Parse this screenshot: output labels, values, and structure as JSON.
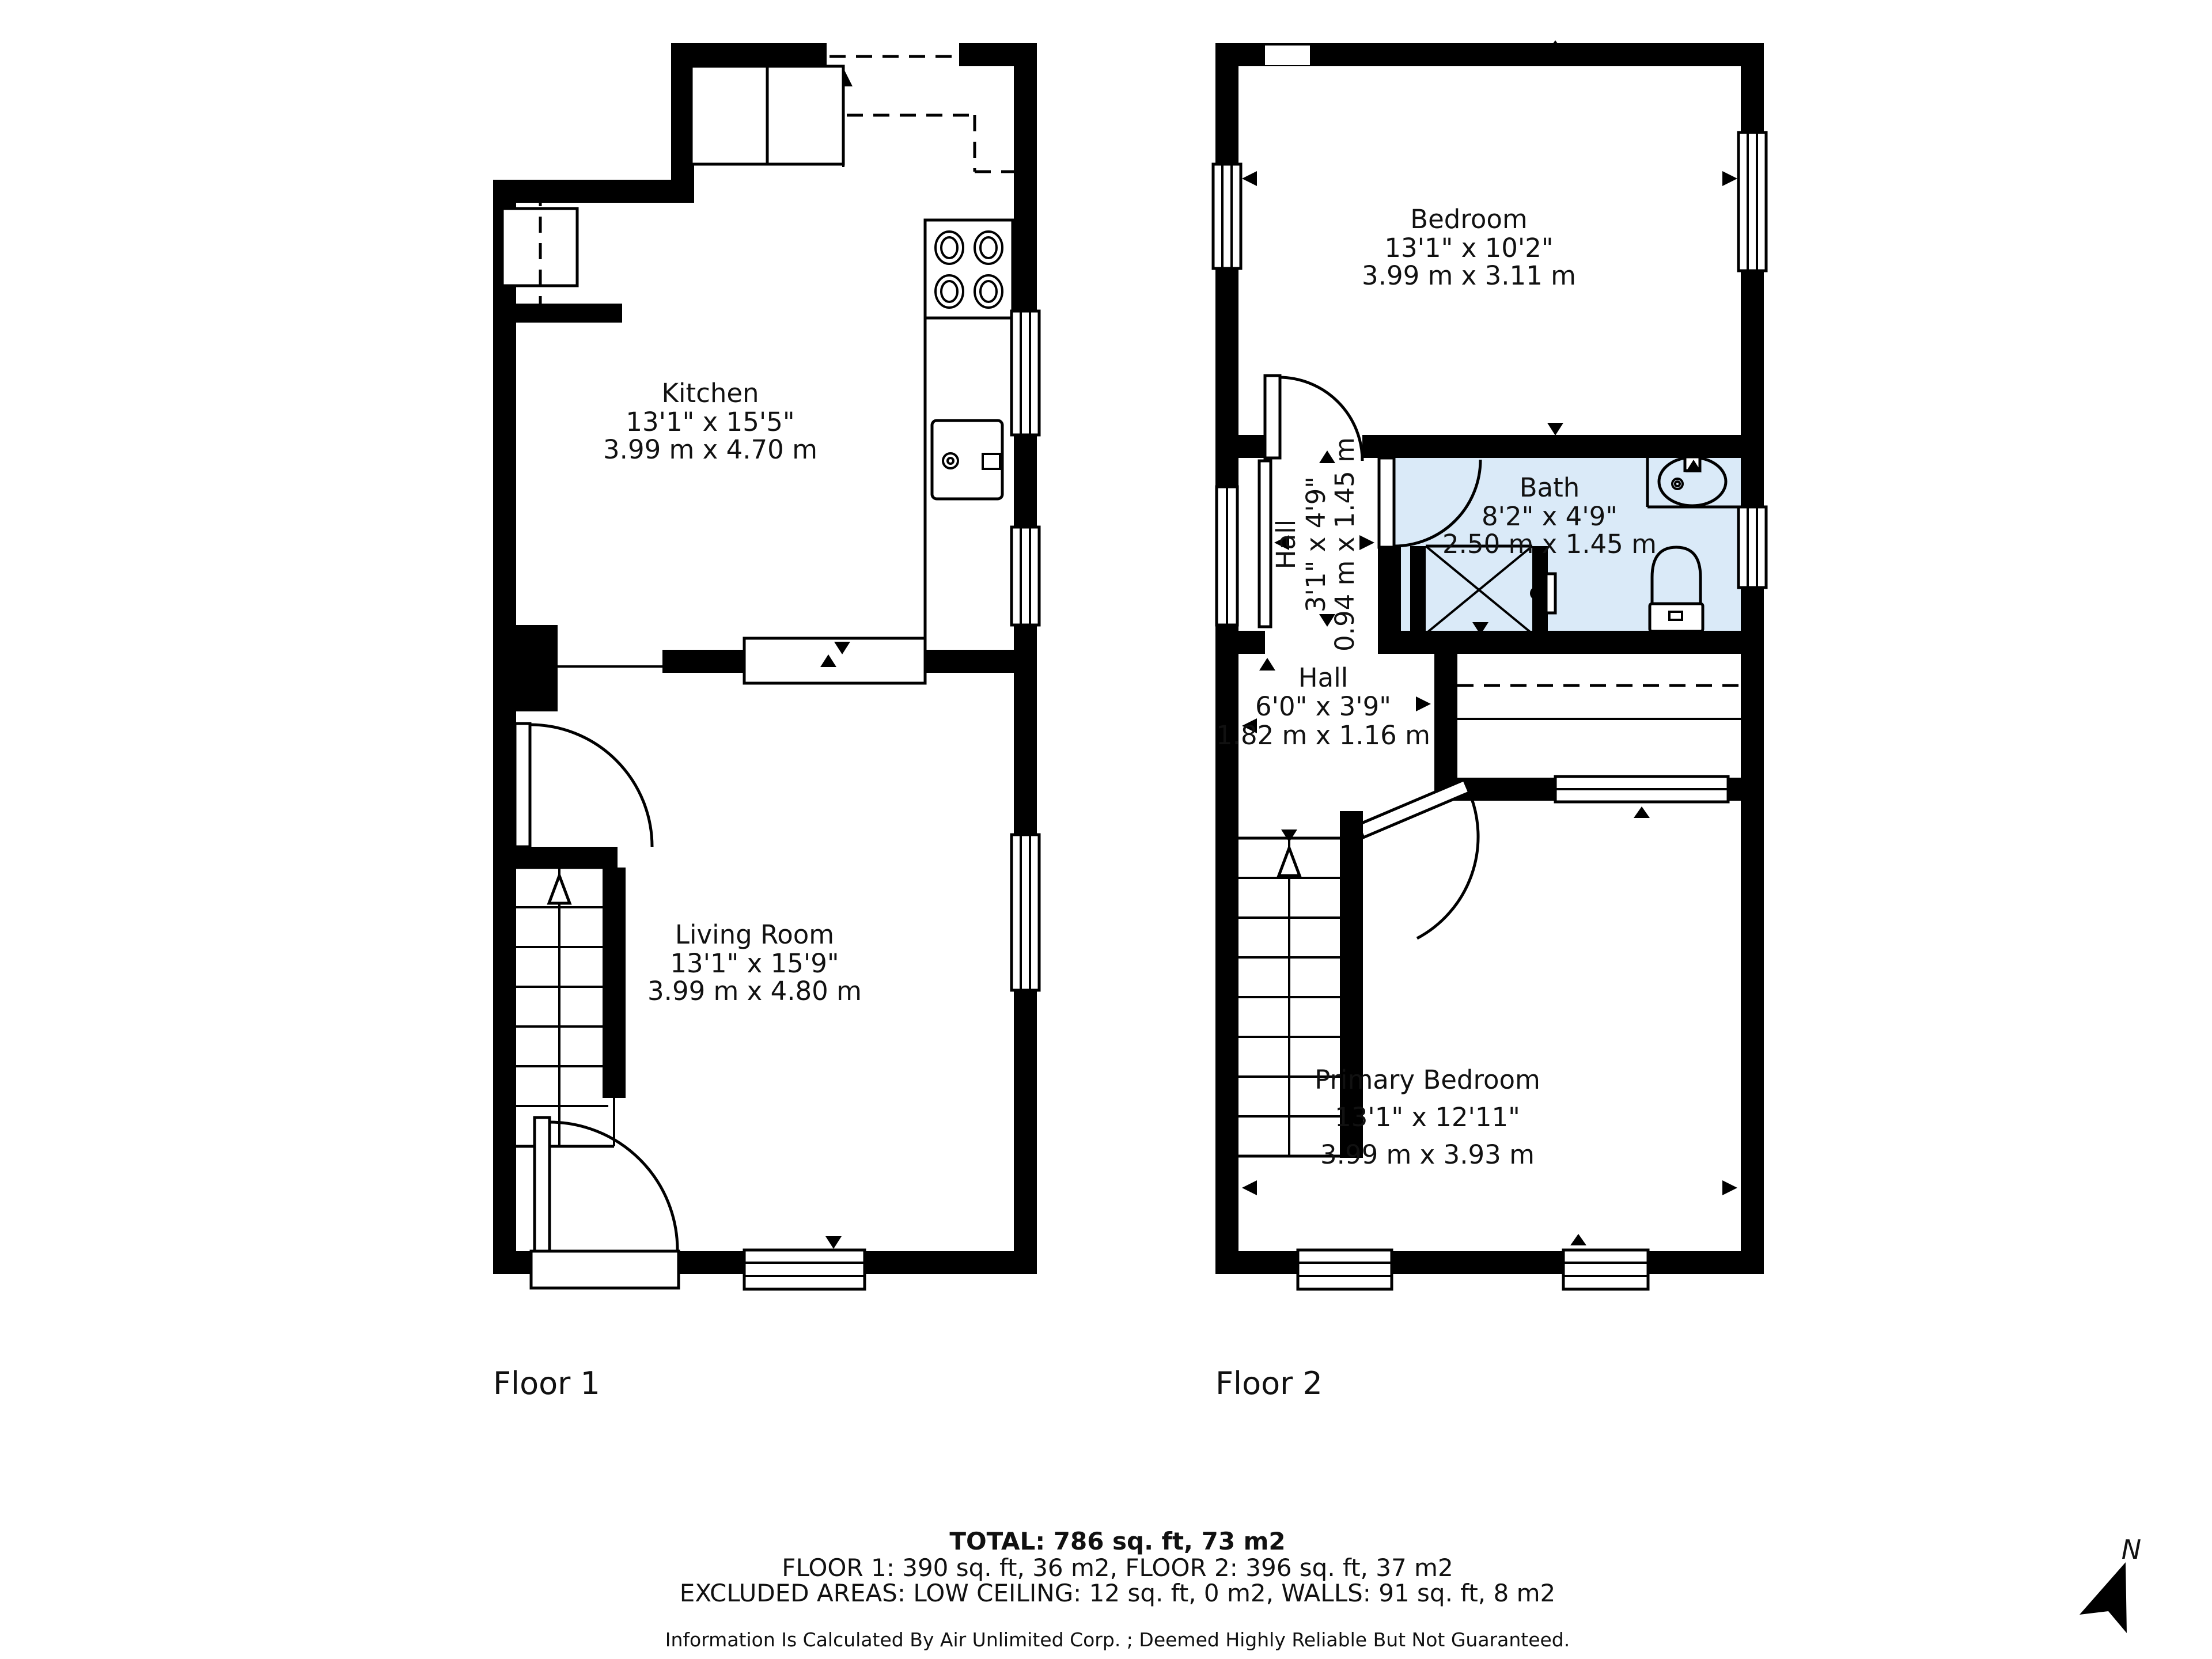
{
  "floors": {
    "floor1_label": "Floor 1",
    "floor2_label": "Floor 2"
  },
  "rooms": {
    "kitchen": {
      "name": "Kitchen",
      "imperial": "13'1\" x 15'5\"",
      "metric": "3.99 m x 4.70 m"
    },
    "living_room": {
      "name": "Living Room",
      "imperial": "13'1\" x 15'9\"",
      "metric": "3.99 m x 4.80 m"
    },
    "bedroom": {
      "name": "Bedroom",
      "imperial": "13'1\" x 10'2\"",
      "metric": "3.99 m x 3.11 m"
    },
    "bath": {
      "name": "Bath",
      "imperial": "8'2\" x 4'9\"",
      "metric": "2.50 m x 1.45 m"
    },
    "hall_small": {
      "name": "Hall",
      "imperial": "3'1\" x 4'9\"",
      "metric": "0.94 m x 1.45 m"
    },
    "hall": {
      "name": "Hall",
      "imperial": "6'0\" x 3'9\"",
      "metric": "1.82 m x 1.16 m"
    },
    "primary_bedroom": {
      "name": "Primary Bedroom",
      "imperial": "13'1\" x 12'11\"",
      "metric": "3.99 m x 3.93 m"
    }
  },
  "summary": {
    "total_line": "TOTAL: 786 sq. ft, 73 m2",
    "floors_line": "FLOOR 1: 390 sq. ft, 36 m2, FLOOR 2: 396 sq. ft, 37 m2",
    "excluded_line": "EXCLUDED AREAS: LOW CEILING: 12 sq. ft, 0 m2, WALLS: 91 sq. ft, 8 m2",
    "disclaimer": "Information Is Calculated By Air Unlimited Corp. ; Deemed Highly Reliable But Not Guaranteed."
  },
  "compass": {
    "north_label": "N"
  },
  "colors": {
    "wall": "#000000",
    "bath_fill": "#daeaf8",
    "background": "#ffffff",
    "text": "#111111"
  }
}
